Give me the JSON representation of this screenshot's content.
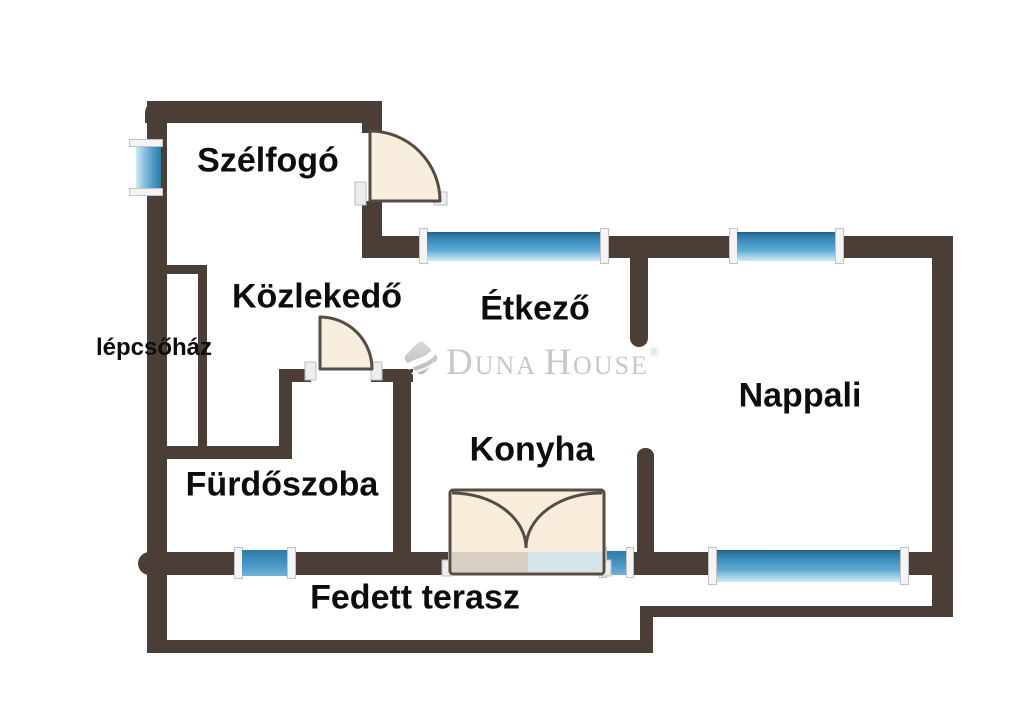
{
  "floorplan": {
    "rooms": {
      "szelfogo": "Szélfogó",
      "kozlekedo": "Közlekedő",
      "etkezo": "Étkező",
      "nappali": "Nappali",
      "konyha": "Konyha",
      "furdoszoba": "Fürdőszoba",
      "fedett_terasz": "Fedett terasz",
      "lepcsohaz": "lépcsőház"
    },
    "watermark": {
      "brand_initial_1": "D",
      "brand_rest_1": "UNA",
      "brand_initial_2": "H",
      "brand_rest_2": "OUSE",
      "registered_mark": "®"
    },
    "colors": {
      "background": "#ffffff",
      "wall": "#4a3e36",
      "window_glass": "#4596c4",
      "window_glass_dark": "#2f7ba6",
      "window_glass_light": "#cfeaf5",
      "window_frame": "#f4f4f4",
      "door_fill": "#f8eedd",
      "door_outline": "#554c44",
      "kitchen_sill_beige": "#d8d0c2",
      "kitchen_sill_blue": "#d5e5ec",
      "label_text": "#0d0d0d",
      "watermark_gray": "#c7c7c7"
    }
  }
}
